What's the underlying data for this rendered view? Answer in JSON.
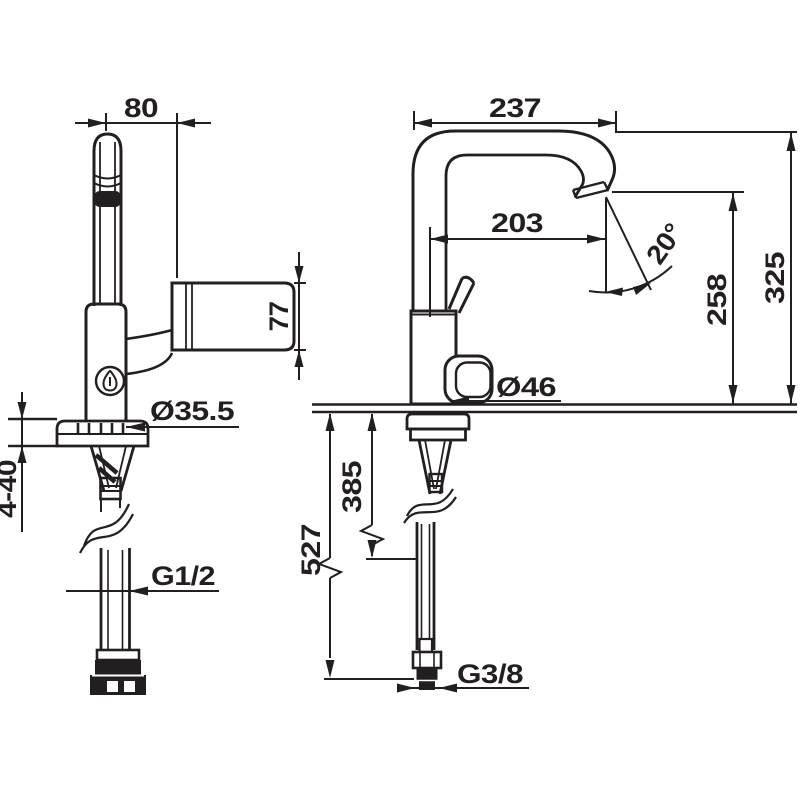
{
  "drawing": {
    "background_color": "#ffffff",
    "line_color": "#231f20",
    "dimensions": {
      "handle_reach": "80",
      "spout_reach": "237",
      "spout_projection": "203",
      "spray_angle": "20°",
      "handle_height": "77",
      "outlet_height": "258",
      "total_height": "325",
      "mounting_hole_diameter": "Ø35.5",
      "knob_diameter": "Ø46",
      "mounting_thickness_range": "4-40",
      "inlet_thread": "G1/2",
      "hose_overall_length": "527",
      "hose_visible_length": "385",
      "outlet_thread": "G3/8"
    }
  }
}
